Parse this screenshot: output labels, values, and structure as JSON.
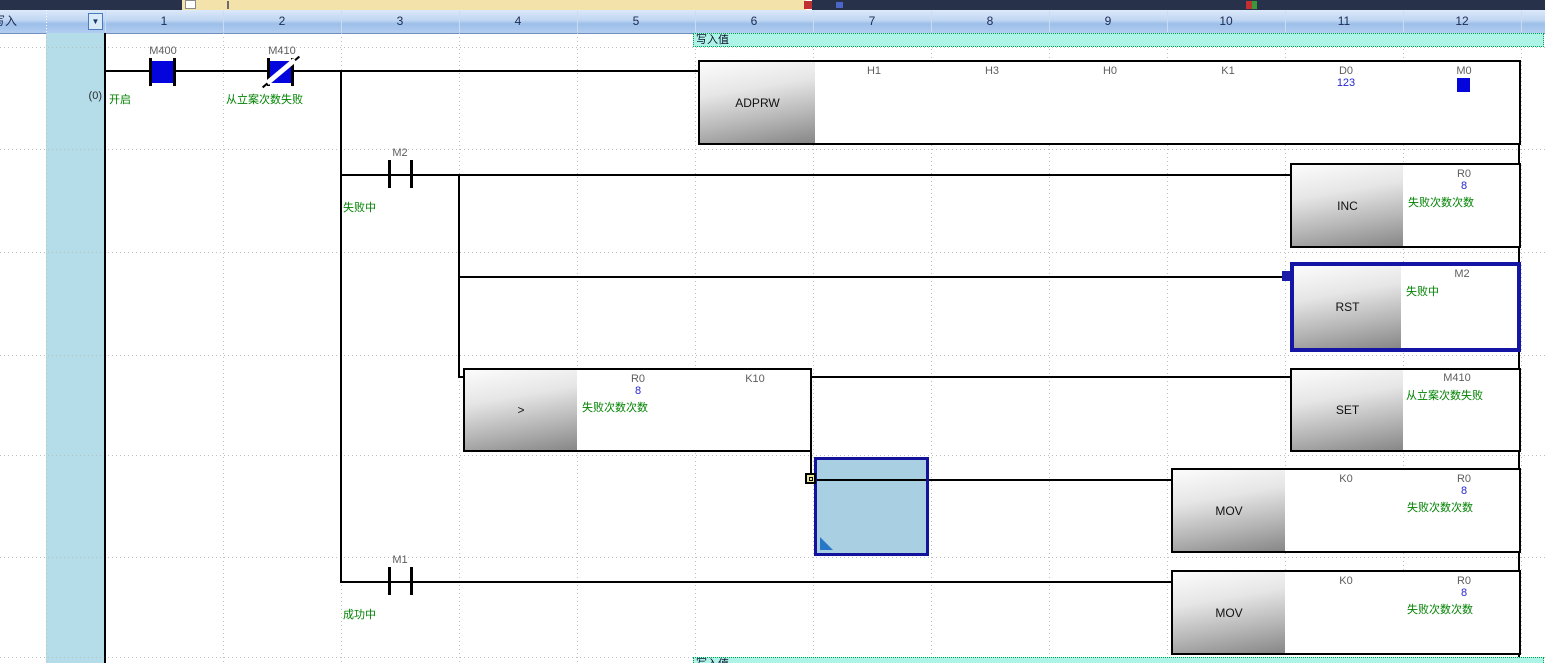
{
  "header": {
    "row_label": "写入",
    "columns": [
      "1",
      "2",
      "3",
      "4",
      "5",
      "6",
      "7",
      "8",
      "9",
      "10",
      "11",
      "12"
    ]
  },
  "top_banner": {
    "label": "写入值"
  },
  "bottom_banner": {
    "label": "写入值"
  },
  "ladder": {
    "step_number": "(0)",
    "contacts": [
      {
        "label": "M400",
        "comment": "开启",
        "type": "normally-open",
        "state": "on"
      },
      {
        "label": "M410",
        "comment": "从立案次数失败",
        "type": "normally-closed",
        "state": "on"
      },
      {
        "label": "M2",
        "comment": "失败中",
        "type": "normally-open",
        "state": "off"
      },
      {
        "label": "M1",
        "comment": "成功中",
        "type": "normally-open",
        "state": "off"
      }
    ],
    "instructions": {
      "adprw": {
        "mnemonic": "ADPRW",
        "params": [
          "H1",
          "H3",
          "H0",
          "K1",
          "D0",
          "M0"
        ],
        "d0_value": "123"
      },
      "inc": {
        "mnemonic": "INC",
        "operand": "R0",
        "current_value": "8",
        "operand_comment": "失败次数次数"
      },
      "rst": {
        "mnemonic": "RST",
        "operand": "M2",
        "operand_comment": "失败中",
        "selected": true
      },
      "compare": {
        "mnemonic": ">",
        "operand1": "R0",
        "operand1_value": "8",
        "operand1_comment": "失败次数次数",
        "operand2": "K10"
      },
      "set": {
        "mnemonic": "SET",
        "operand": "M410",
        "operand_comment": "从立案次数失败"
      },
      "mov_fail": {
        "mnemonic": "MOV",
        "source": "K0",
        "dest": "R0",
        "dest_value": "8",
        "dest_comment": "失败次数次数"
      },
      "mov_success": {
        "mnemonic": "MOV",
        "source": "K0",
        "dest": "R0",
        "dest_value": "8",
        "dest_comment": "失败次数次数"
      }
    }
  },
  "colors": {
    "comment_green": "#008200",
    "monitor_value_blue": "#2626d2",
    "contact_on_blue": "#0404dd",
    "selection_navy": "#12129a",
    "selected_cell_fill": "#a9cfe2",
    "banner_cyan": "#adf4e6",
    "banner_border_green": "#00a050",
    "header_blue": "#9dbfe9",
    "device_label_gray": "#5e5e5e"
  }
}
